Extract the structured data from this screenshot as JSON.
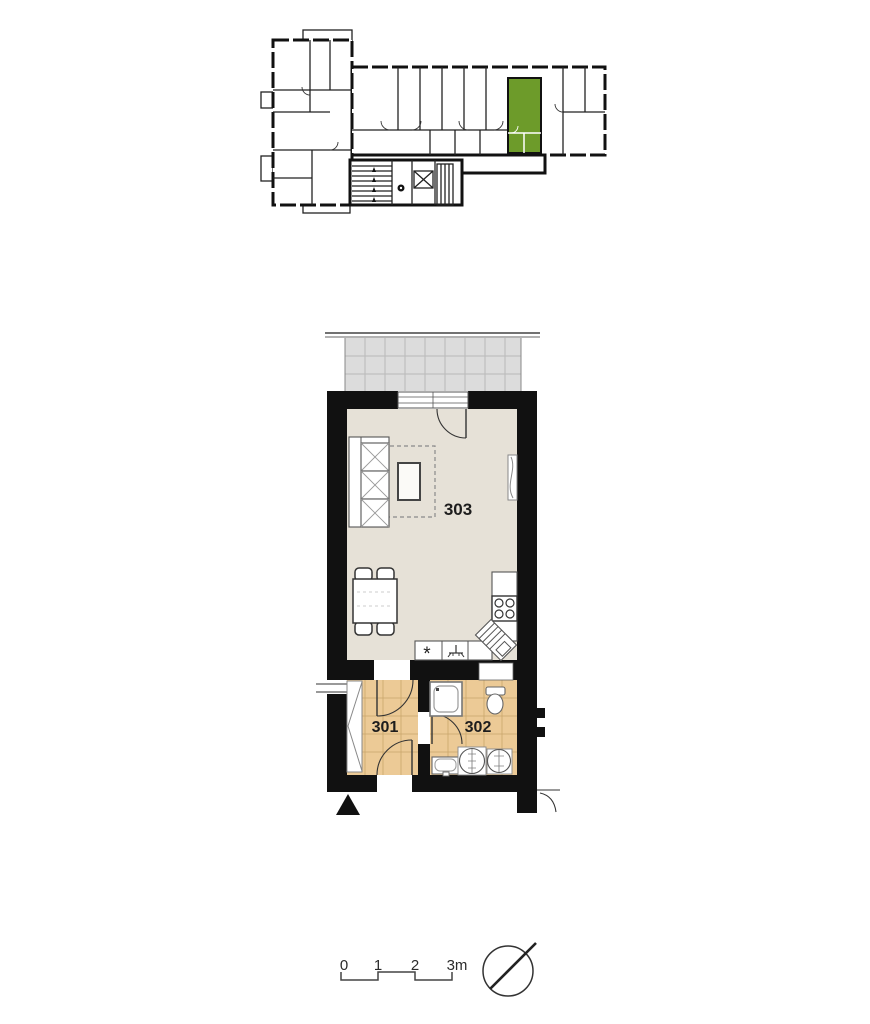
{
  "overview_plan": {
    "highlighted_unit_room": "303",
    "stair_symbol": "stairs",
    "elevator_symbol": "elevator"
  },
  "unit_plan": {
    "rooms": [
      {
        "number": "301"
      },
      {
        "number": "302"
      },
      {
        "number": "303"
      }
    ],
    "appliance_mark": "*"
  },
  "legend": {
    "scale_ticks": [
      "0",
      "1",
      "2",
      "3m"
    ]
  },
  "colors": {
    "unit_highlight": "#6d9b2a",
    "room_floor": "#e6e1d7",
    "tile_floor": "#ecca96",
    "balcony_floor": "#dcdcdc",
    "wall": "#111111",
    "page_background": "#ffffff"
  }
}
